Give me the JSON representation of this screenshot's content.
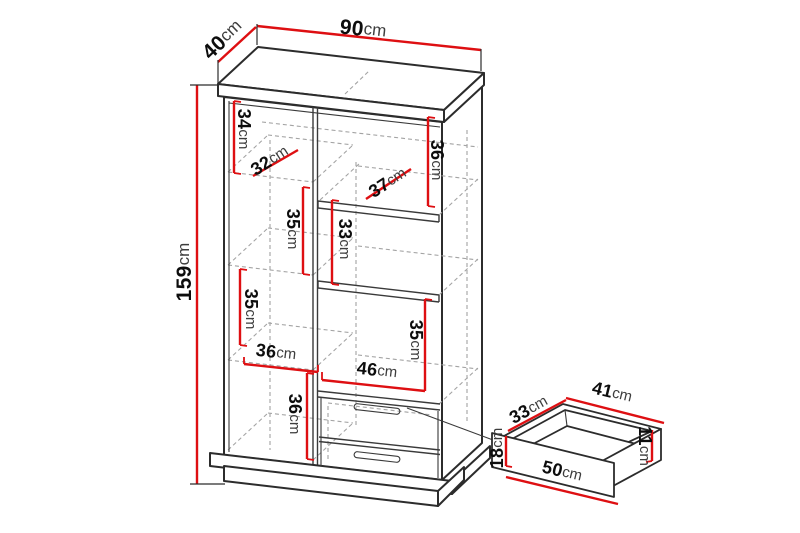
{
  "page": {
    "background": "#ffffff",
    "description": "Furniture dimension diagram: tall cabinet with shelves and two drawers, plus detached drawer detail"
  },
  "colors": {
    "dimension_red": "#de0f12",
    "outline": "#2c2c2c",
    "hidden_line": "#a3a3a3",
    "label_number": "#0d0d0d",
    "label_unit": "#3d3d3d"
  },
  "dimensions": {
    "depth_top": {
      "value": "40",
      "unit": "cm"
    },
    "width_top": {
      "value": "90",
      "unit": "cm"
    },
    "height_total": {
      "value": "159",
      "unit": "cm"
    },
    "upper_left_height": {
      "value": "34",
      "unit": "cm"
    },
    "upper_left_shelf_depth": {
      "value": "32",
      "unit": "cm"
    },
    "upper_right_height": {
      "value": "36",
      "unit": "cm"
    },
    "upper_right_shelf_depth": {
      "value": "37",
      "unit": "cm"
    },
    "left_mid_height": {
      "value": "35",
      "unit": "cm"
    },
    "right_mid_height": {
      "value": "33",
      "unit": "cm"
    },
    "left_lower_height": {
      "value": "35",
      "unit": "cm"
    },
    "right_lower_height": {
      "value": "35",
      "unit": "cm"
    },
    "left_compartment_width": {
      "value": "36",
      "unit": "cm"
    },
    "right_compartment_width": {
      "value": "46",
      "unit": "cm"
    },
    "bottom_left_height": {
      "value": "36",
      "unit": "cm"
    },
    "drawer_depth": {
      "value": "33",
      "unit": "cm"
    },
    "drawer_width": {
      "value": "41",
      "unit": "cm"
    },
    "drawer_front_height": {
      "value": "18",
      "unit": "cm"
    },
    "drawer_side_height": {
      "value": "11",
      "unit": "cm"
    },
    "drawer_front_width": {
      "value": "50",
      "unit": "cm"
    }
  }
}
